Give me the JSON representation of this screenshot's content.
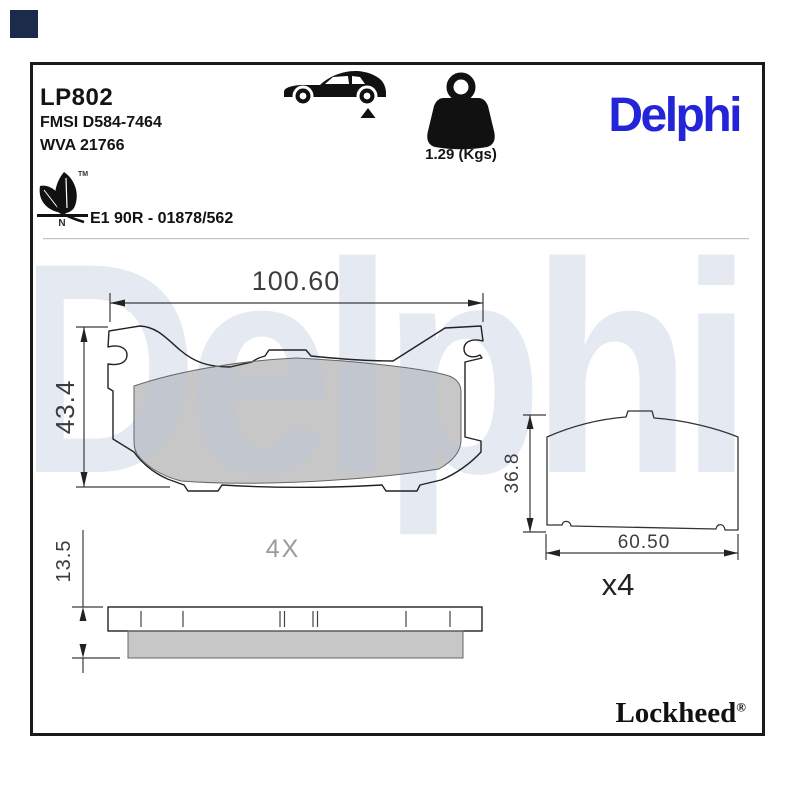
{
  "meta": {
    "corner_square_color": "#1c2b4a"
  },
  "header": {
    "part_number": "LP802",
    "fmsi_code": "FMSI D584-7464",
    "wva_code": "WVA 21766",
    "weight": "1.29 (Kgs)",
    "brand": "Delphi",
    "eco": {
      "tm": "TM",
      "letter": "N"
    },
    "homologation": "E1 90R - 01878/562",
    "icons": {
      "vehicle": "car-side-icon",
      "axle_marker": "rear-axle-triangle-icon",
      "weight": "kettlebell-weight-icon",
      "eco": "leaf-icon"
    }
  },
  "views": {
    "front": {
      "width_mm": "100.60",
      "height_mm": "43.4"
    },
    "side": {
      "thickness_mm": "13.5",
      "quantity": "4X"
    },
    "back": {
      "height_mm": "36.8",
      "width_mm": "60.50",
      "quantity": "x4"
    }
  },
  "watermark": {
    "text": "Delphi"
  },
  "footer": {
    "brand": "Lockheed",
    "reg_mark": "®"
  },
  "colors": {
    "brand_blue": "#2424d8",
    "watermark_blue": "#b8c6dc",
    "friction_gray": "#c7c7c7",
    "line_dark": "#222222",
    "dim_text": "#3d3d3d",
    "frame_border": "#1a1a1a"
  }
}
